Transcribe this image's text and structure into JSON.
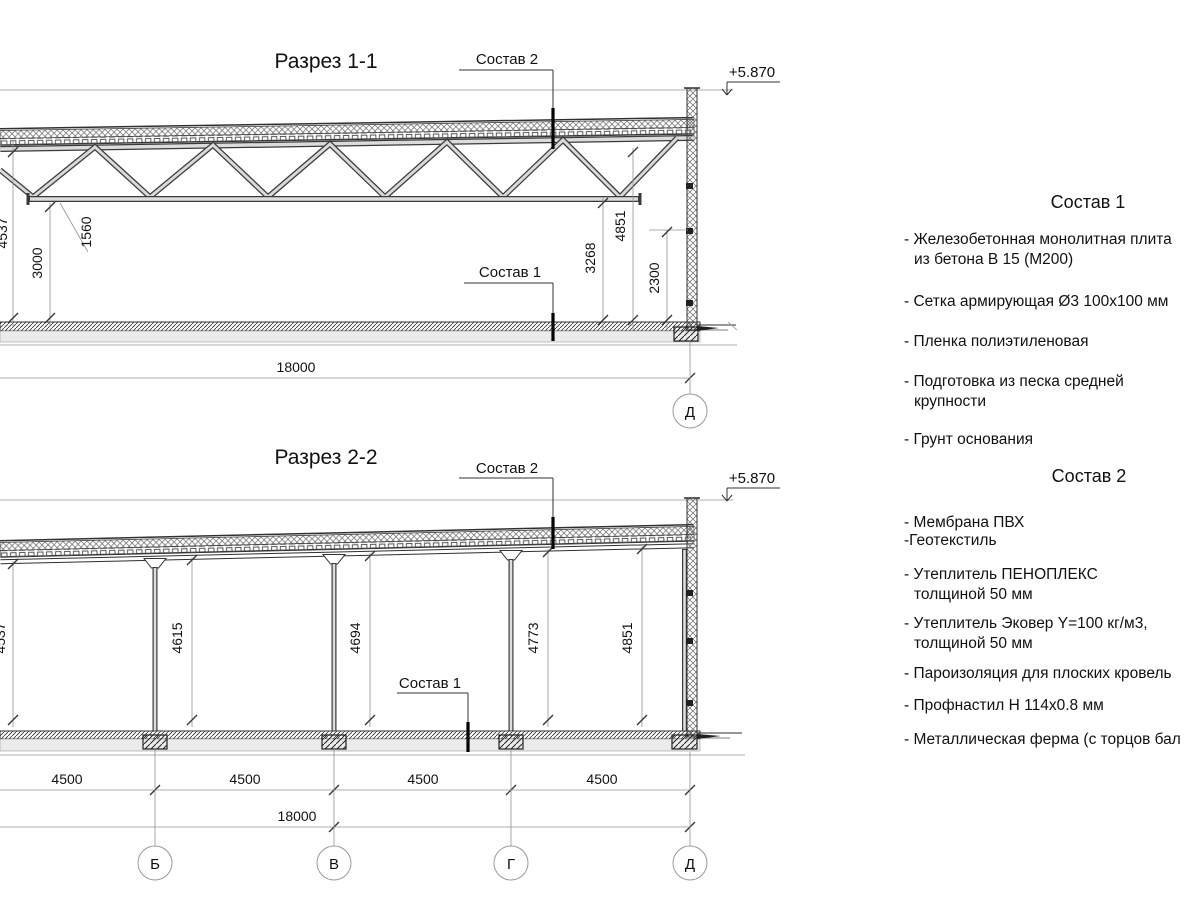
{
  "drawing": {
    "section1": {
      "title": "Разрез 1-1",
      "sostav2_label": "Состав 2",
      "sostav1_label": "Состав 1",
      "elevation": "+5.870",
      "dim_4537": "4537",
      "dim_3000": "3000",
      "dim_1560": "1560",
      "dim_3268": "3268",
      "dim_4851": "4851",
      "dim_2300": "2300",
      "dim_overall": "18000",
      "axis_d": "Д"
    },
    "section2": {
      "title": "Разрез 2-2",
      "sostav2_label": "Состав 2",
      "sostav1_label": "Состав 1",
      "elevation": "+5.870",
      "height_dims": [
        "4537",
        "4615",
        "4694",
        "4773",
        "4851"
      ],
      "bay_dims": [
        "4500",
        "4500",
        "4500",
        "4500"
      ],
      "dim_overall": "18000",
      "axes": [
        "Б",
        "В",
        "Г",
        "Д"
      ]
    }
  },
  "legend": {
    "sostav1": {
      "title": "Состав 1",
      "items": [
        "- Железобетонная  монолитная плита\nиз бетона В 15 (М200)",
        "- Сетка армирующая Ø3 100х100 мм",
        "- Пленка полиэтиленовая",
        "- Подготовка из песка средней\nкрупности",
        "- Грунт основания"
      ]
    },
    "sostav2": {
      "title": "Состав 2",
      "items": [
        "- Мембрана ПВХ",
        "-Геотекстиль",
        "- Утеплитель ПЕНОПЛЕКС\nтолщиной 50 мм",
        "- Утеплитель Эковер Y=100 кг/м3,\nтолщиной 50 мм",
        "- Пароизоляция для плоских кровель",
        "- Профнастил Н 114х0.8 мм",
        "- Металлическая ферма (с торцов бал"
      ]
    }
  },
  "colors": {
    "line_dark": "#2f2f2f",
    "line_dim": "#949494",
    "member_fill": "#d9d9d9",
    "layer_light": "#ebebeb",
    "text": "#111111"
  }
}
